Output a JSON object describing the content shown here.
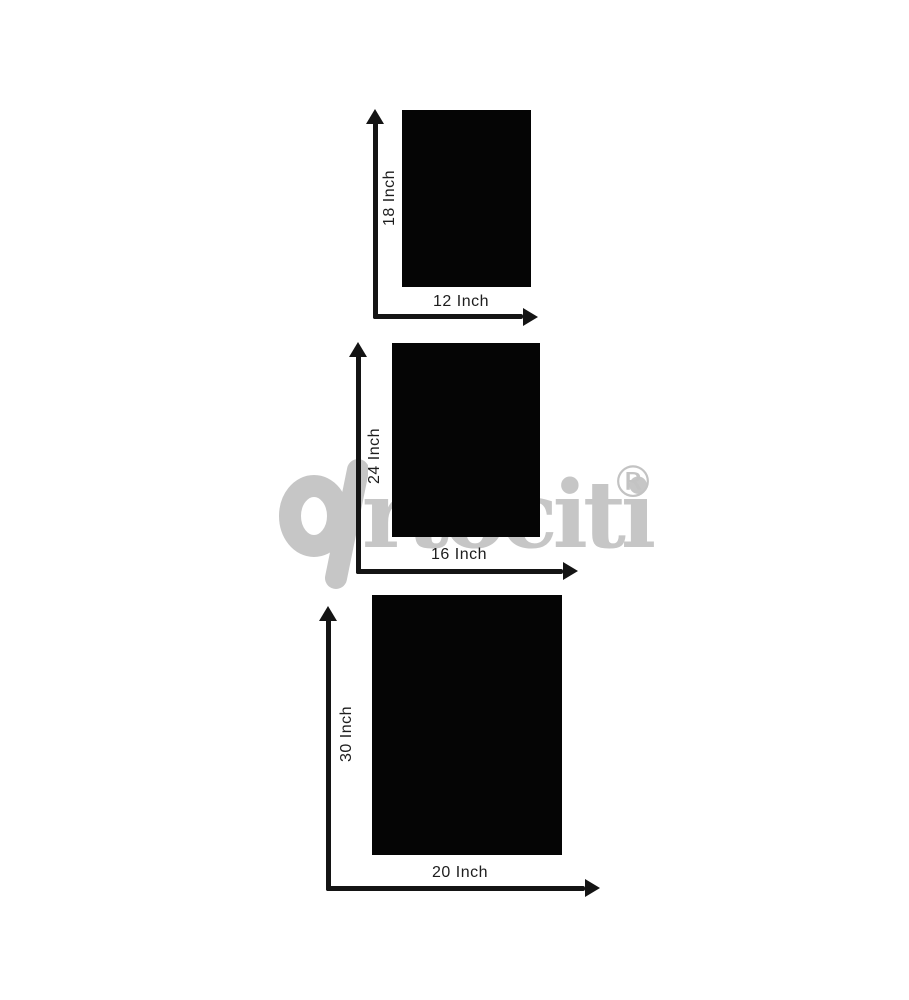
{
  "watermark": {
    "brand": "artociti",
    "text": "rtociti",
    "registered": "®",
    "color": "#c6c6c6"
  },
  "sizes": [
    {
      "name": "small",
      "height_label": "18 Inch",
      "width_label": "12 Inch"
    },
    {
      "name": "medium",
      "height_label": "24 Inch",
      "width_label": "16 Inch"
    },
    {
      "name": "large",
      "height_label": "30 Inch",
      "width_label": "20 Inch"
    }
  ],
  "colors": {
    "background": "#ffffff",
    "panel": "#050505",
    "arrow": "#141414",
    "label": "#1d1d1d",
    "watermark": "#c6c6c6"
  }
}
